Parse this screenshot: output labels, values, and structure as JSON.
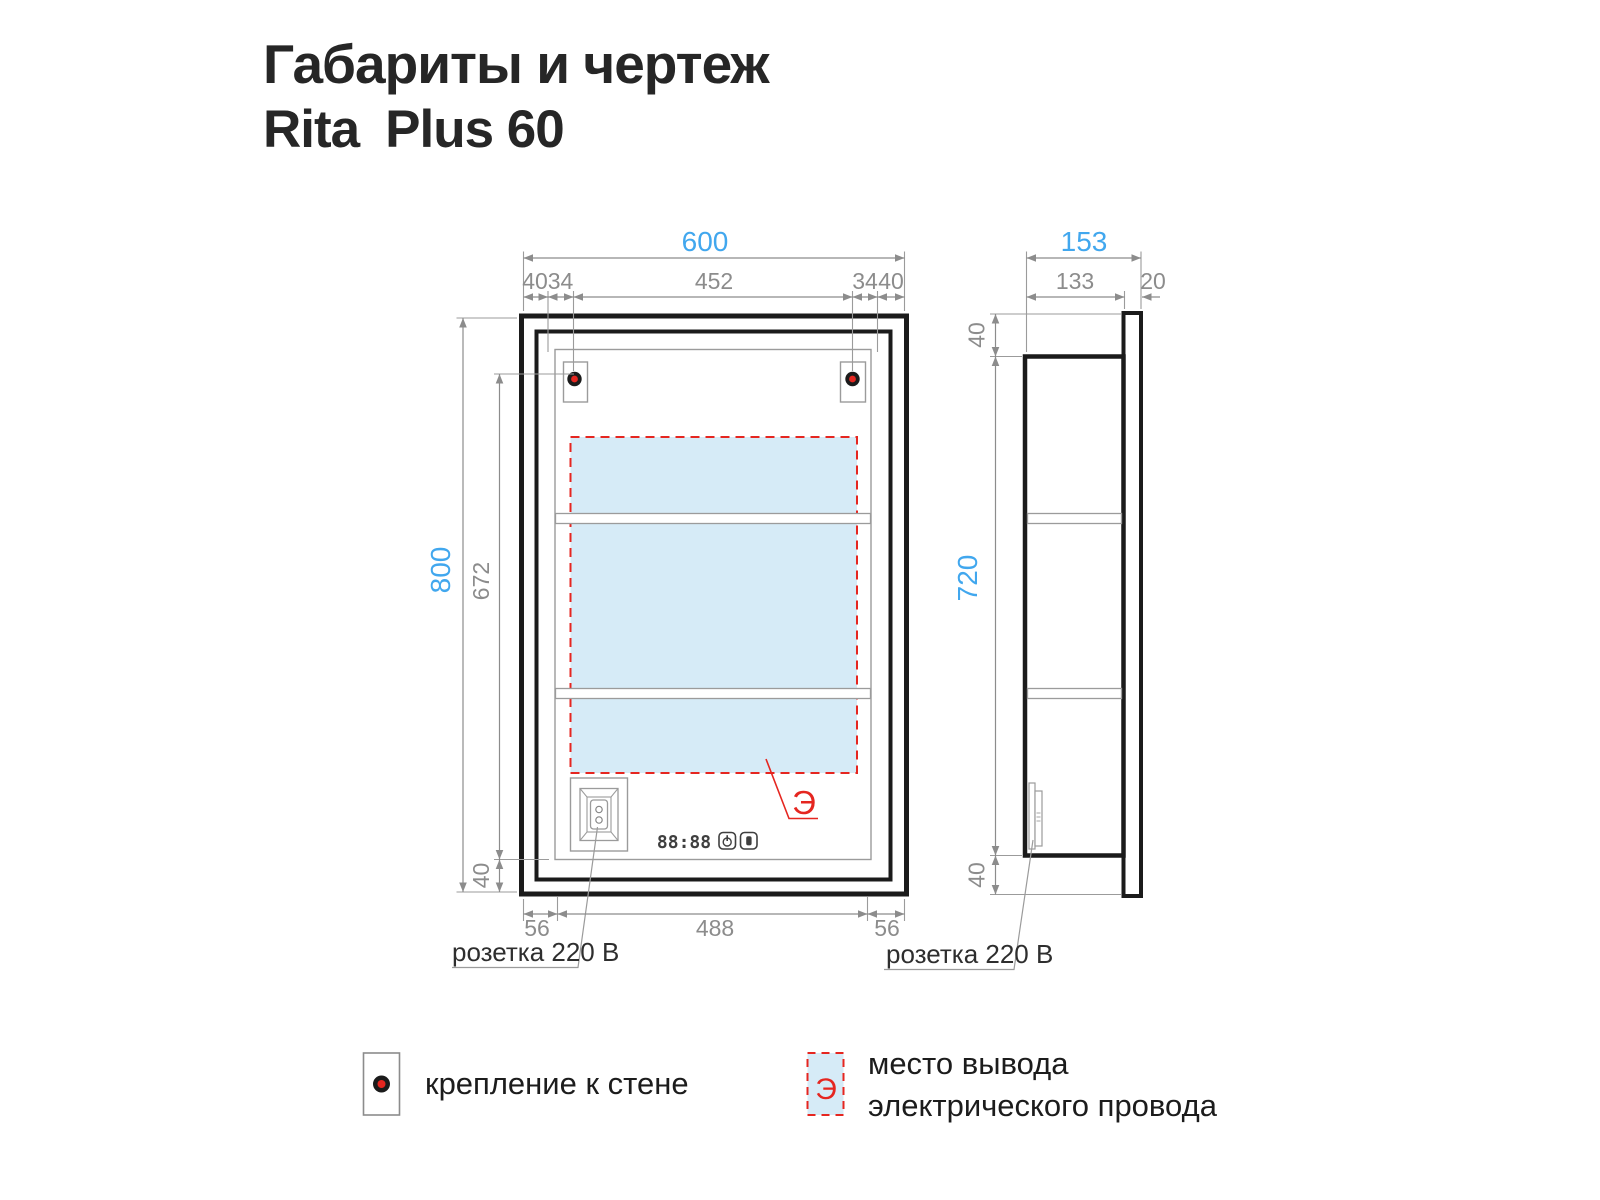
{
  "title": {
    "line1": "Габариты и чертеж",
    "brand": "Rita",
    "model": "Plus 60"
  },
  "front_view": {
    "dim_width_total": "600",
    "top_dims": [
      "40",
      "34",
      "452",
      "34",
      "40"
    ],
    "dim_height_total": "800",
    "dim_mount_height": "672",
    "dim_bottom_offset": "40",
    "bottom_dims": [
      "56",
      "488",
      "56"
    ],
    "socket_label": "розетка 220 В",
    "display_digits": "88:88",
    "electric_mark": "Э"
  },
  "side_view": {
    "dim_depth_total": "153",
    "dim_depth_body": "133",
    "dim_door_thickness": "20",
    "dim_top_offset": "40",
    "dim_height_body": "720",
    "dim_bottom_offset": "40",
    "socket_label": "розетка 220 В"
  },
  "legend": {
    "mount_label": "крепление к стене",
    "electric_symbol": "Э",
    "electric_label_line1": "место вывода",
    "electric_label_line2": "электрического провода"
  },
  "colors": {
    "accent_blue": "#41a7ee",
    "dim_gray": "#8c8c8c",
    "line_black": "#1b1b1b",
    "zone_fill": "#d6ebf7",
    "red": "#e52620"
  }
}
